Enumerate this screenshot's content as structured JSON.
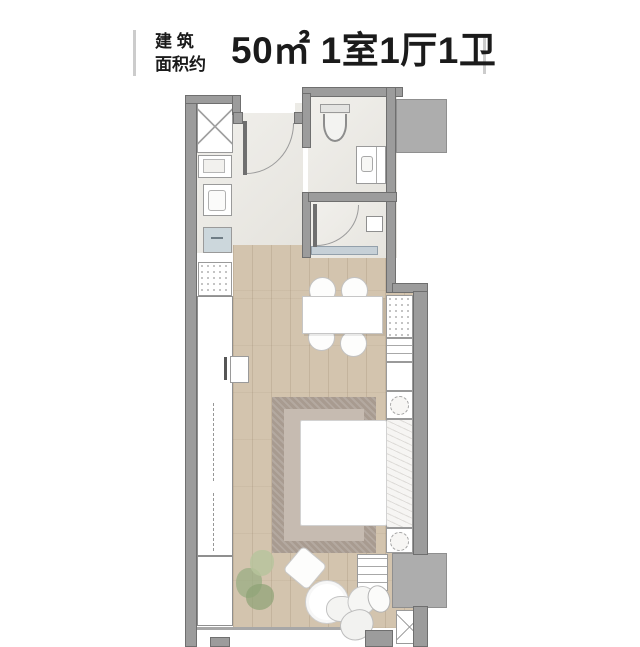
{
  "title": {
    "prefix_line1": "建 筑",
    "prefix_line2": "面积约",
    "area": "50㎡",
    "layout": "1室1厅1卫"
  },
  "palette": {
    "text": "#1b1b1b",
    "accent_bar": "#cccccc",
    "wall": "#9c9c9c",
    "wall_line": "#6f6f6f",
    "shaft": "#adadad",
    "tile": "#eae8e2",
    "wood": "#d3c4ae",
    "rug_outer": "#a89b90",
    "rug_inner": "#c6bbb1",
    "glass_screen": "#c6d0d7",
    "kitchen_sink": "#ccd7dc",
    "plant_green": "#9aad83"
  }
}
